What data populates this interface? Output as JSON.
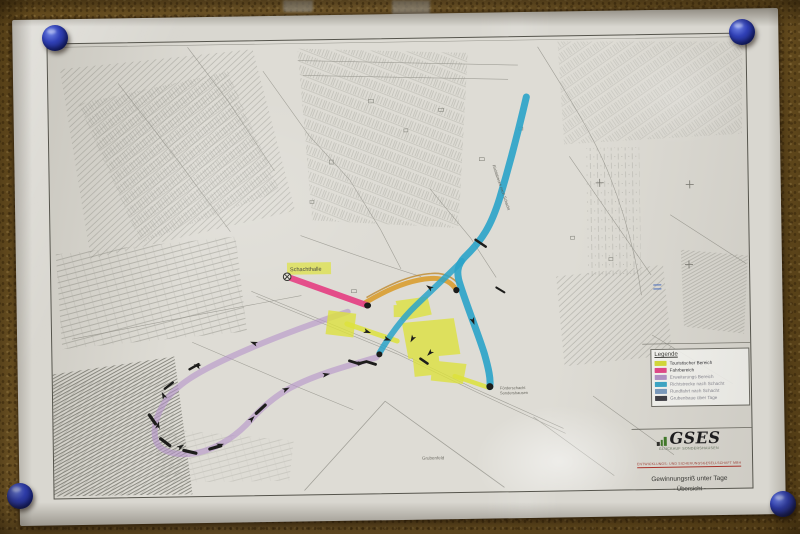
{
  "legend": {
    "title": "Legende",
    "items": [
      {
        "label": "Touristischer Bereich",
        "color": "#d8dd3a"
      },
      {
        "label": "Fahrbereich",
        "color": "#e4478a"
      },
      {
        "label": "Erweiterungs Bereich",
        "color": "#b493c9"
      },
      {
        "label": "Richtstrecke nach Schacht",
        "color": "#3ba8c9"
      },
      {
        "label": "Rundfahrt nach Schacht",
        "color": "#7b9cc0"
      },
      {
        "label": "Grubenbaue über Tage",
        "color": "#3c3c44"
      }
    ]
  },
  "title_block": {
    "company": "GSES",
    "company_line1": "Glückauf Sondershausen",
    "company_line2": "Entwicklungs- und Sicherungsgesellschaft mbH",
    "map_title": "Gewinnungsriß unter Tage",
    "map_subtitle": "- Übersicht -"
  },
  "map_labels": {
    "highlight": "Schachthalle",
    "shaft_line1": "Förderschacht",
    "shaft_line2": "Sondershausen",
    "bottom": "Grubenfeld",
    "route": "Richtstrecke nach Schacht"
  },
  "colors": {
    "route_cyan": "#2aa3c9",
    "route_pink": "#e43f82",
    "route_orange": "#d99a26",
    "route_orange_dark": "#bb7d16",
    "route_purple": "#b493c9",
    "route_yellow": "#dde23c",
    "pin_blue": "#3040b6",
    "logo_green": "#3f7a28",
    "ink": "#1d1d1b"
  }
}
